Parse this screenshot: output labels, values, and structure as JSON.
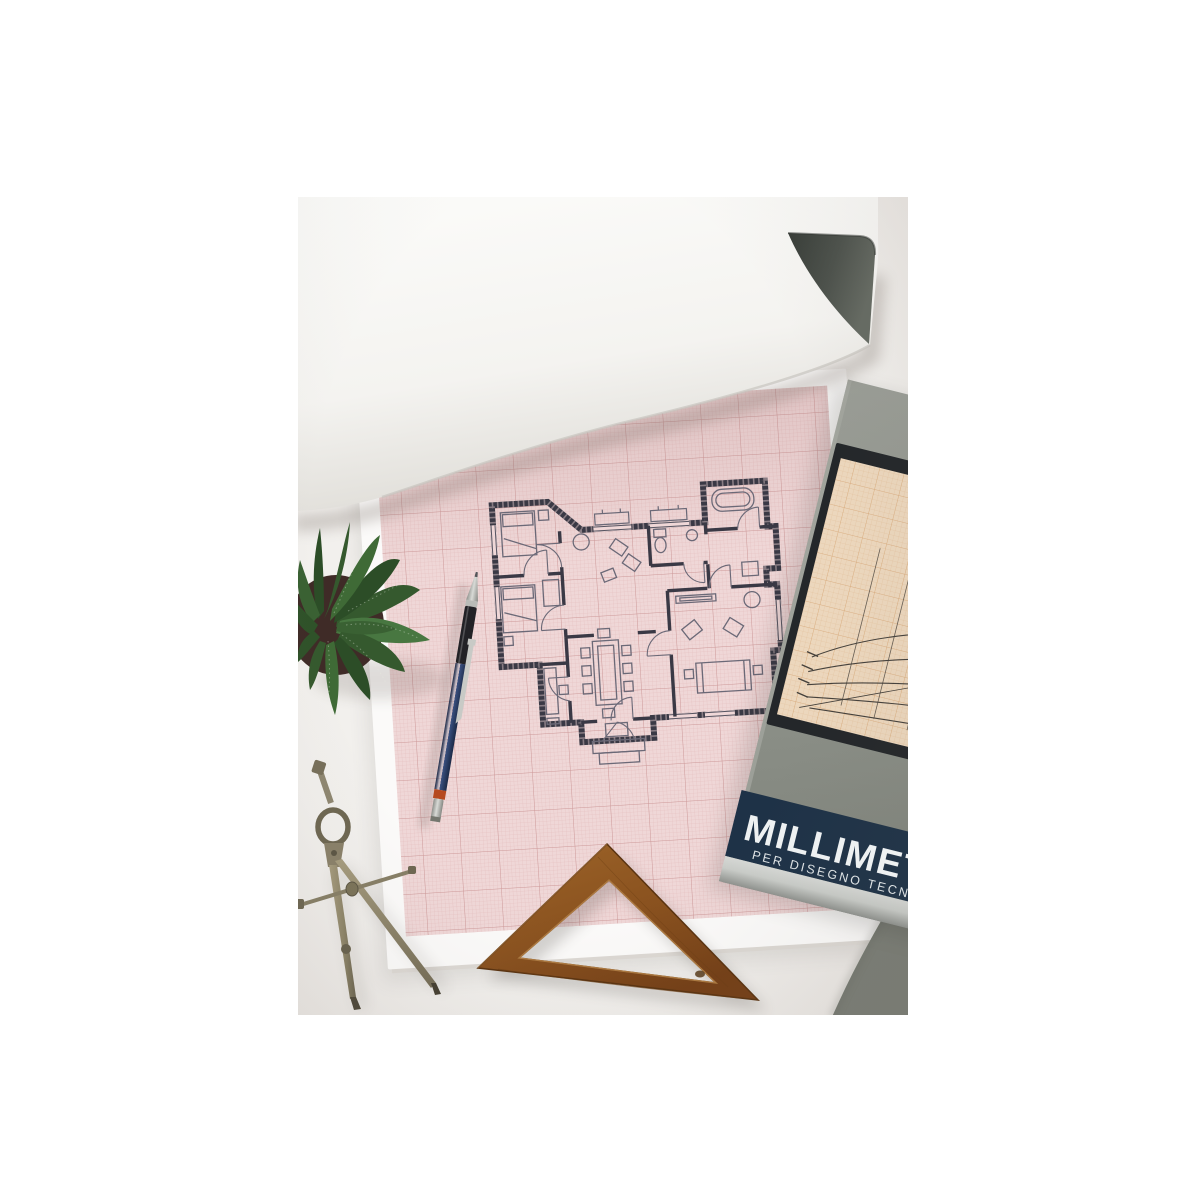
{
  "cover": {
    "title": "MILLIMETR",
    "subtitle": "PER DISEGNO TECNICO",
    "colors": {
      "band": "#1e3247",
      "cover_gray": "#8c9088",
      "silver_stripe": "#c9ccc8",
      "text": "#eef1f2",
      "inset_paper": "#ecd7bd"
    }
  },
  "graph_pad": {
    "paper_color": "#efd7d7",
    "grid_fine_color": "#d8a4a4",
    "grid_bold_color": "#c78f8f",
    "margin_color": "#fbfaf9"
  },
  "floor_plan": {
    "wall_color": "#3a3945",
    "furniture_color": "#6b6977"
  },
  "objects": [
    {
      "name": "rolled-paper-sheet"
    },
    {
      "name": "graph-paper-pad"
    },
    {
      "name": "floor-plan-drawing"
    },
    {
      "name": "notepad-cover"
    },
    {
      "name": "cover-inset-illustration"
    },
    {
      "name": "mechanical-pencil"
    },
    {
      "name": "drafting-compass"
    },
    {
      "name": "wooden-set-square"
    },
    {
      "name": "succulent-plant"
    }
  ],
  "palette": {
    "desk": "#f2f0ed",
    "pencil_navy": "#2c4068",
    "pencil_ring_orange": "#b64a20",
    "brass": "#968c70",
    "wood": "#8f5a26",
    "plant_green": "#3a6133"
  }
}
